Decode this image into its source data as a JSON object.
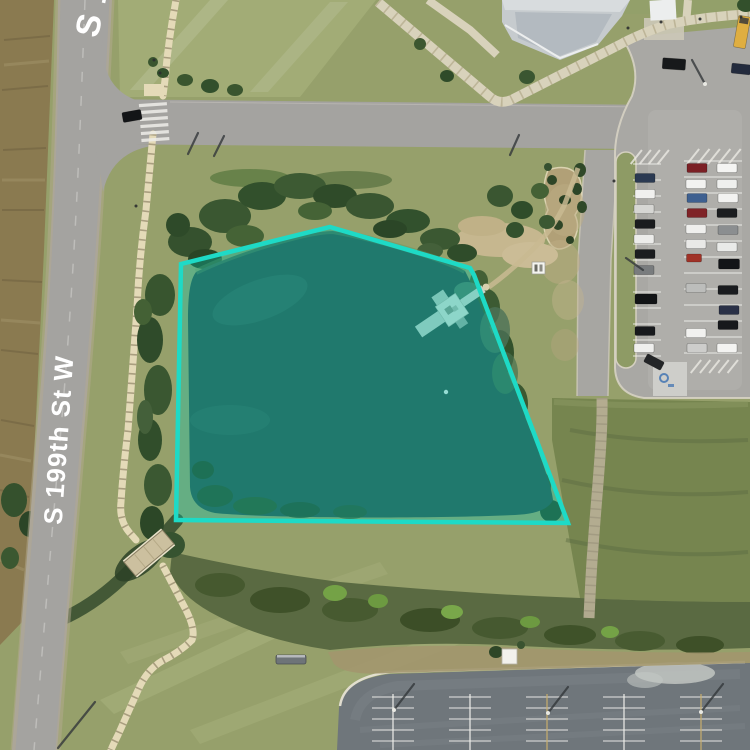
{
  "map": {
    "road_labels": {
      "main": "S 199th St W",
      "top": "S 199th St W"
    },
    "colors": {
      "parcel_stroke": "#1edac6",
      "parcel_fill": "rgba(0,205,185,0.32)",
      "water": "#30514a",
      "grass": "#96a06b",
      "road": "#a4a3a0"
    }
  },
  "parcel": {
    "points": "330,227 470,268 474,275 568,523 176,520 181,264",
    "fill": "rgba(0,205,185,0.32)",
    "stroke": "#1edac6",
    "stroke_width": 4.5
  },
  "map_objects": {
    "cars": [
      [
        645,
        178,
        20,
        9,
        "#2b3a52",
        0
      ],
      [
        645,
        194,
        20,
        9,
        "#f0f0ee",
        0
      ],
      [
        644,
        209,
        20,
        9,
        "#d6d6d3",
        0
      ],
      [
        645,
        224,
        20,
        9,
        "#1a1c1e",
        0
      ],
      [
        644,
        239,
        20,
        9,
        "#ececea",
        0
      ],
      [
        645,
        254,
        20,
        9,
        "#1b1d1f",
        0
      ],
      [
        644,
        270,
        20,
        9,
        "#797c7e",
        0
      ],
      [
        646,
        299,
        22,
        10,
        "#121416",
        0
      ],
      [
        645,
        331,
        20,
        9,
        "#17191c",
        0
      ],
      [
        644,
        348,
        20,
        9,
        "#efefed",
        0
      ],
      [
        654,
        362,
        19,
        9,
        "#232527",
        28
      ],
      [
        697,
        168,
        20,
        9,
        "#7b2025",
        0
      ],
      [
        696,
        184,
        20,
        9,
        "#f2f2f0",
        0
      ],
      [
        697,
        198,
        20,
        9,
        "#3e6090",
        0
      ],
      [
        697,
        213,
        20,
        9,
        "#7f2327",
        0
      ],
      [
        696,
        229,
        20,
        9,
        "#efefed",
        0
      ],
      [
        696,
        244,
        20,
        9,
        "#e9e9e7",
        0
      ],
      [
        694,
        258,
        15,
        8,
        "#a03227",
        0
      ],
      [
        696,
        288,
        20,
        9,
        "#bcbdbb",
        0
      ],
      [
        696,
        333,
        20,
        9,
        "#f1f1ef",
        0
      ],
      [
        697,
        348,
        20,
        9,
        "#cdcdcb",
        0
      ],
      [
        727,
        168,
        20,
        9,
        "#f4f4f2",
        0
      ],
      [
        727,
        184,
        20,
        9,
        "#eff0ee",
        0
      ],
      [
        728,
        198,
        20,
        9,
        "#f2f2f0",
        0
      ],
      [
        727,
        213,
        20,
        9,
        "#1b1d1f",
        0
      ],
      [
        728,
        230,
        20,
        9,
        "#8b8e90",
        0
      ],
      [
        727,
        247,
        20,
        9,
        "#e9eae8",
        0
      ],
      [
        729,
        264,
        21,
        10,
        "#131518",
        0
      ],
      [
        728,
        290,
        20,
        9,
        "#1a1c1f",
        0
      ],
      [
        729,
        310,
        20,
        9,
        "#2a3147",
        0
      ],
      [
        728,
        325,
        20,
        9,
        "#17191c",
        0
      ],
      [
        727,
        348,
        20,
        9,
        "#f3f3f1",
        0
      ],
      [
        674,
        64,
        23,
        11,
        "#17191b",
        4
      ],
      [
        741,
        69,
        19,
        10,
        "#232b3d",
        6
      ],
      [
        742,
        32,
        12,
        32,
        "#dfae41",
        10,
        "#44403a"
      ],
      [
        132,
        116,
        19,
        10,
        "#131517",
        -10
      ]
    ],
    "pole_shadows": [
      [
        394,
        710,
        414,
        684,
        1
      ],
      [
        548,
        713,
        568,
        687,
        1
      ],
      [
        701,
        712,
        723,
        684,
        1
      ],
      [
        188,
        154,
        198,
        133,
        0
      ],
      [
        214,
        156,
        224,
        136,
        0
      ],
      [
        510,
        155,
        519,
        135,
        0
      ],
      [
        705,
        84,
        692,
        60,
        1
      ],
      [
        643,
        270,
        626,
        258,
        0
      ],
      [
        95,
        702,
        58,
        748,
        0
      ]
    ],
    "posts": [
      [
        628,
        28
      ],
      [
        661,
        22
      ],
      [
        700,
        19
      ],
      [
        741,
        17
      ],
      [
        154,
        60
      ],
      [
        160,
        73
      ],
      [
        136,
        206
      ],
      [
        614,
        181
      ]
    ]
  },
  "parking": {
    "right_lot_stall_rows": [
      {
        "x1": 633,
        "x2": 661,
        "y_start": 164,
        "y_end": 356,
        "step": 16
      },
      {
        "x1": 684,
        "x2": 742,
        "y_start": 161,
        "y_end": 361,
        "step": 16
      }
    ],
    "bottom_lot": {
      "x_starts": [
        372,
        449,
        526,
        603,
        680
      ],
      "block_width": 42,
      "row_ys": [
        697,
        708,
        719,
        730,
        741
      ],
      "head_x": [
        393,
        470,
        547,
        624,
        701
      ],
      "head_colors": [
        "#efefeb",
        "#efefeb",
        "#c8ae6e",
        "#efefeb",
        "#c8ae6e"
      ],
      "head_y1": 694,
      "head_y2": 750
    },
    "hatch_zones": [
      {
        "x": 628,
        "y": 150,
        "w": 36,
        "h": 14,
        "n": 4
      },
      {
        "x": 684,
        "y": 149,
        "w": 52,
        "h": 15,
        "n": 5
      },
      {
        "x": 688,
        "y": 360,
        "w": 46,
        "h": 13,
        "n": 5
      }
    ]
  }
}
